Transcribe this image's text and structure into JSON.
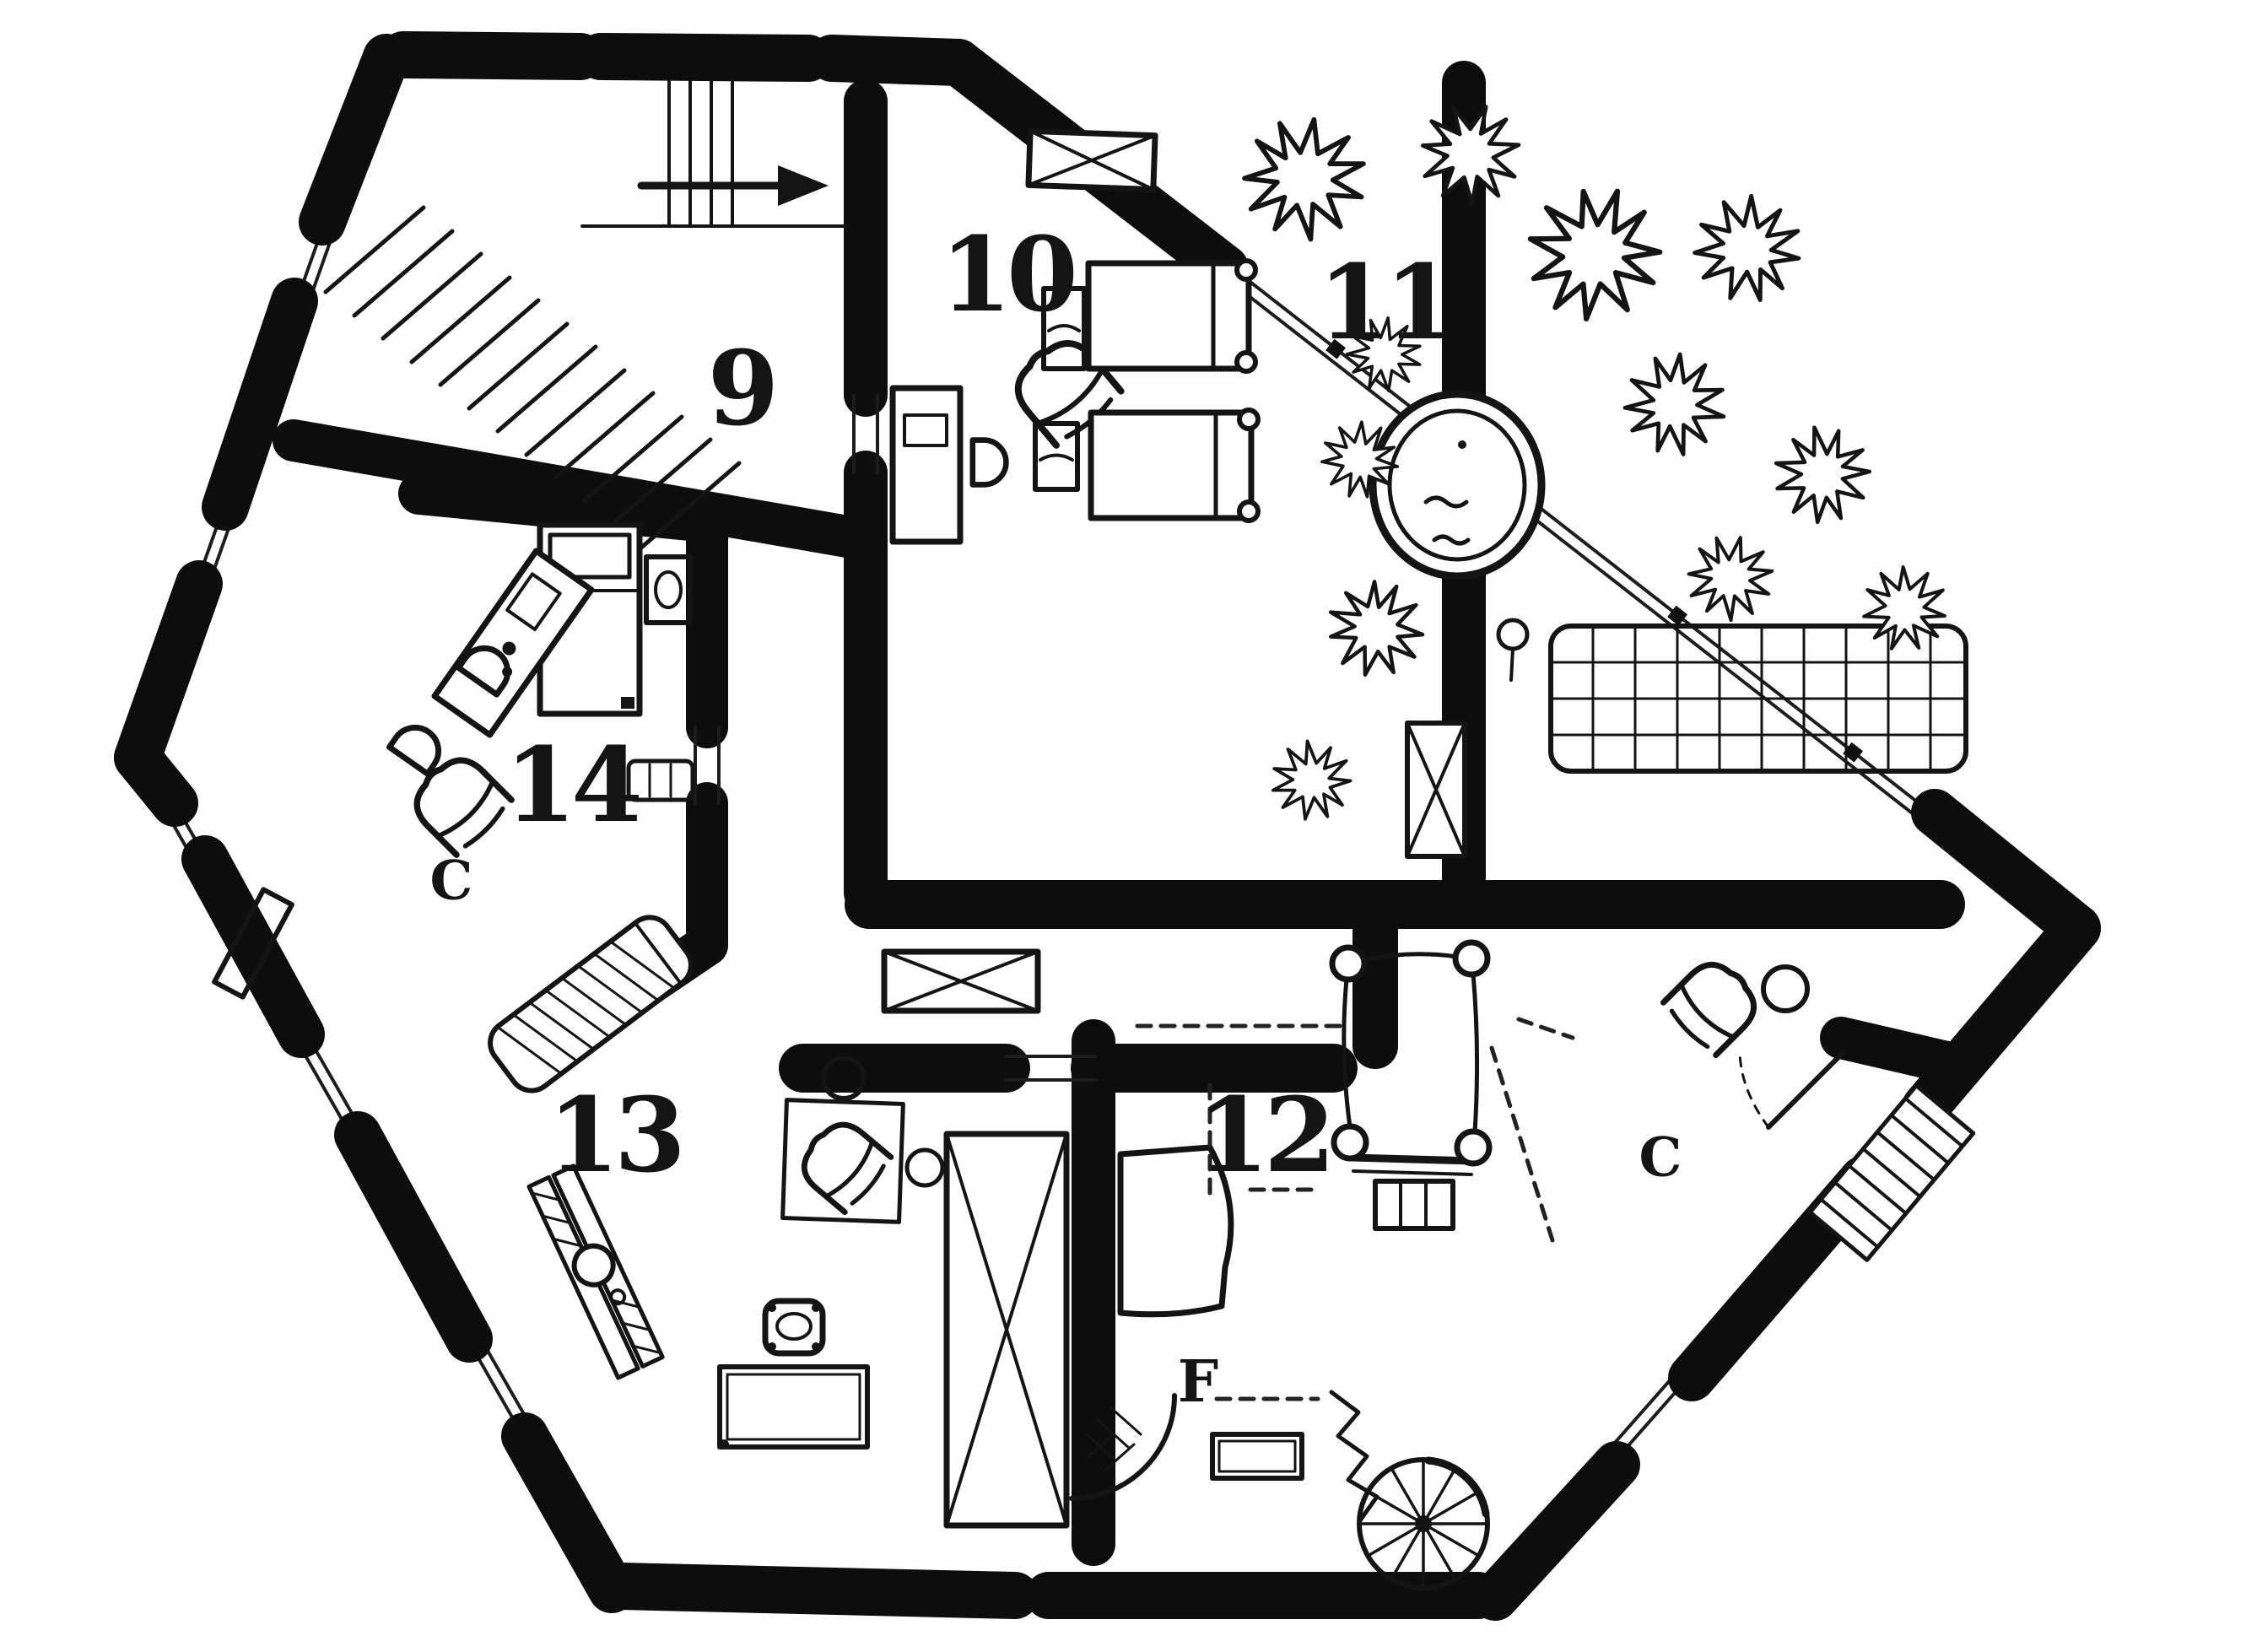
{
  "plan": {
    "colors": {
      "ink": "#101010",
      "paper": "#ffffff"
    },
    "labels": {
      "room9": "9",
      "room10": "10",
      "room11": "11",
      "room12": "12",
      "room13": "13",
      "room14": "14",
      "closet14": "C",
      "closet12": "C",
      "fireplace": "F"
    }
  }
}
